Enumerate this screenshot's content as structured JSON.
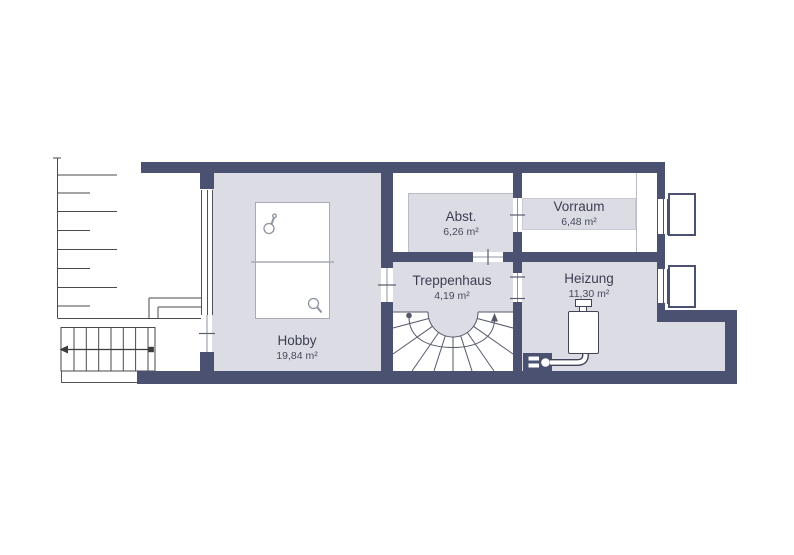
{
  "floorplan": {
    "background_color": "#ffffff",
    "wall_color": "#4b5170",
    "floor_color": "#dcdde4",
    "rooms": [
      {
        "name": "Hobby",
        "area": "19,84 m²"
      },
      {
        "name": "Treppenhaus",
        "area": "4,19 m²"
      },
      {
        "name": "Abst.",
        "area": "6,26 m²"
      },
      {
        "name": "Vorraum",
        "area": "6,48 m²"
      },
      {
        "name": "Heizung",
        "area": "11,30 m²"
      }
    ],
    "features": [
      "table-tennis-table",
      "table-tennis-paddle",
      "winder-staircase",
      "exterior-staircase",
      "direction-arrow",
      "terrace-hatching",
      "boiler",
      "electric-meter",
      "window",
      "light-well",
      "door-opening-tick"
    ]
  }
}
